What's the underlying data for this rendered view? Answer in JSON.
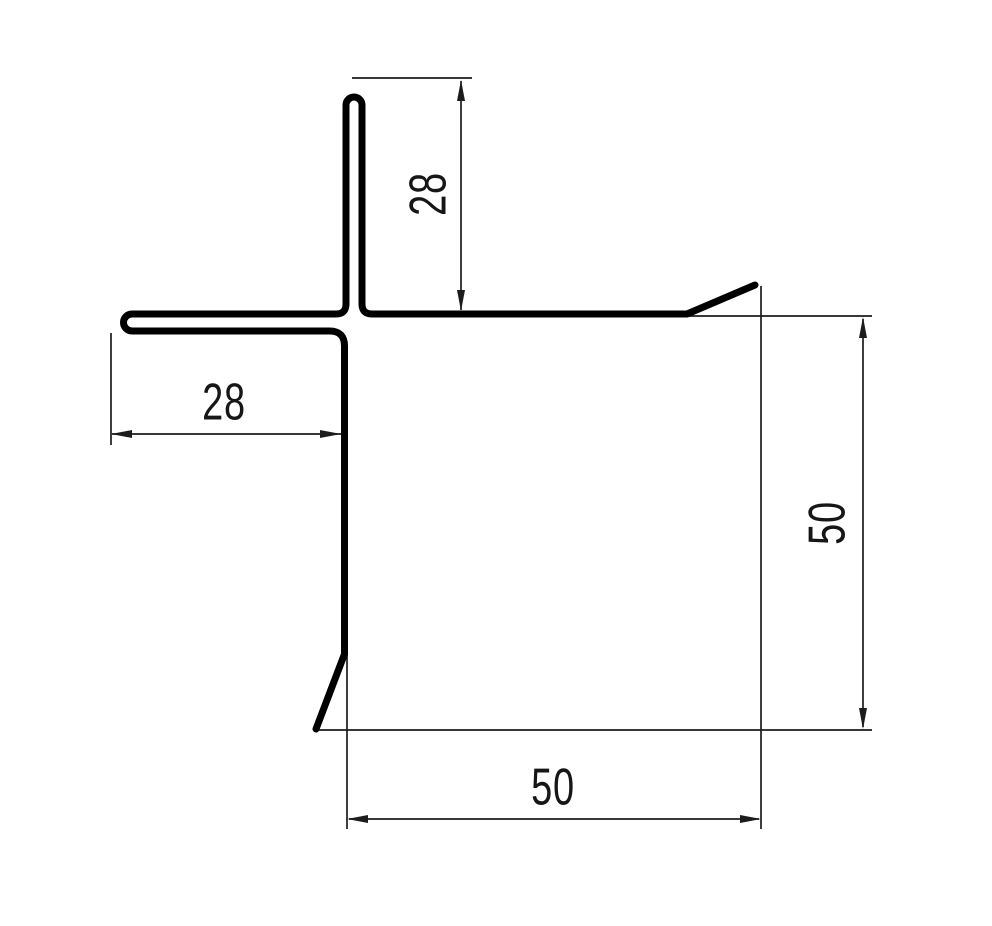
{
  "drawing": {
    "kind": "technical-profile-cross-section",
    "colors": {
      "background": "#ffffff",
      "profile_line": "#000000",
      "dimension_line": "#1c1c1c",
      "text": "#161616"
    },
    "dimensions": {
      "top_flange": {
        "label": "28",
        "orientation": "vertical"
      },
      "left_flange": {
        "label": "28",
        "orientation": "horizontal"
      },
      "right_side": {
        "label": "50",
        "orientation": "vertical"
      },
      "bottom_side": {
        "label": "50",
        "orientation": "horizontal"
      }
    }
  }
}
